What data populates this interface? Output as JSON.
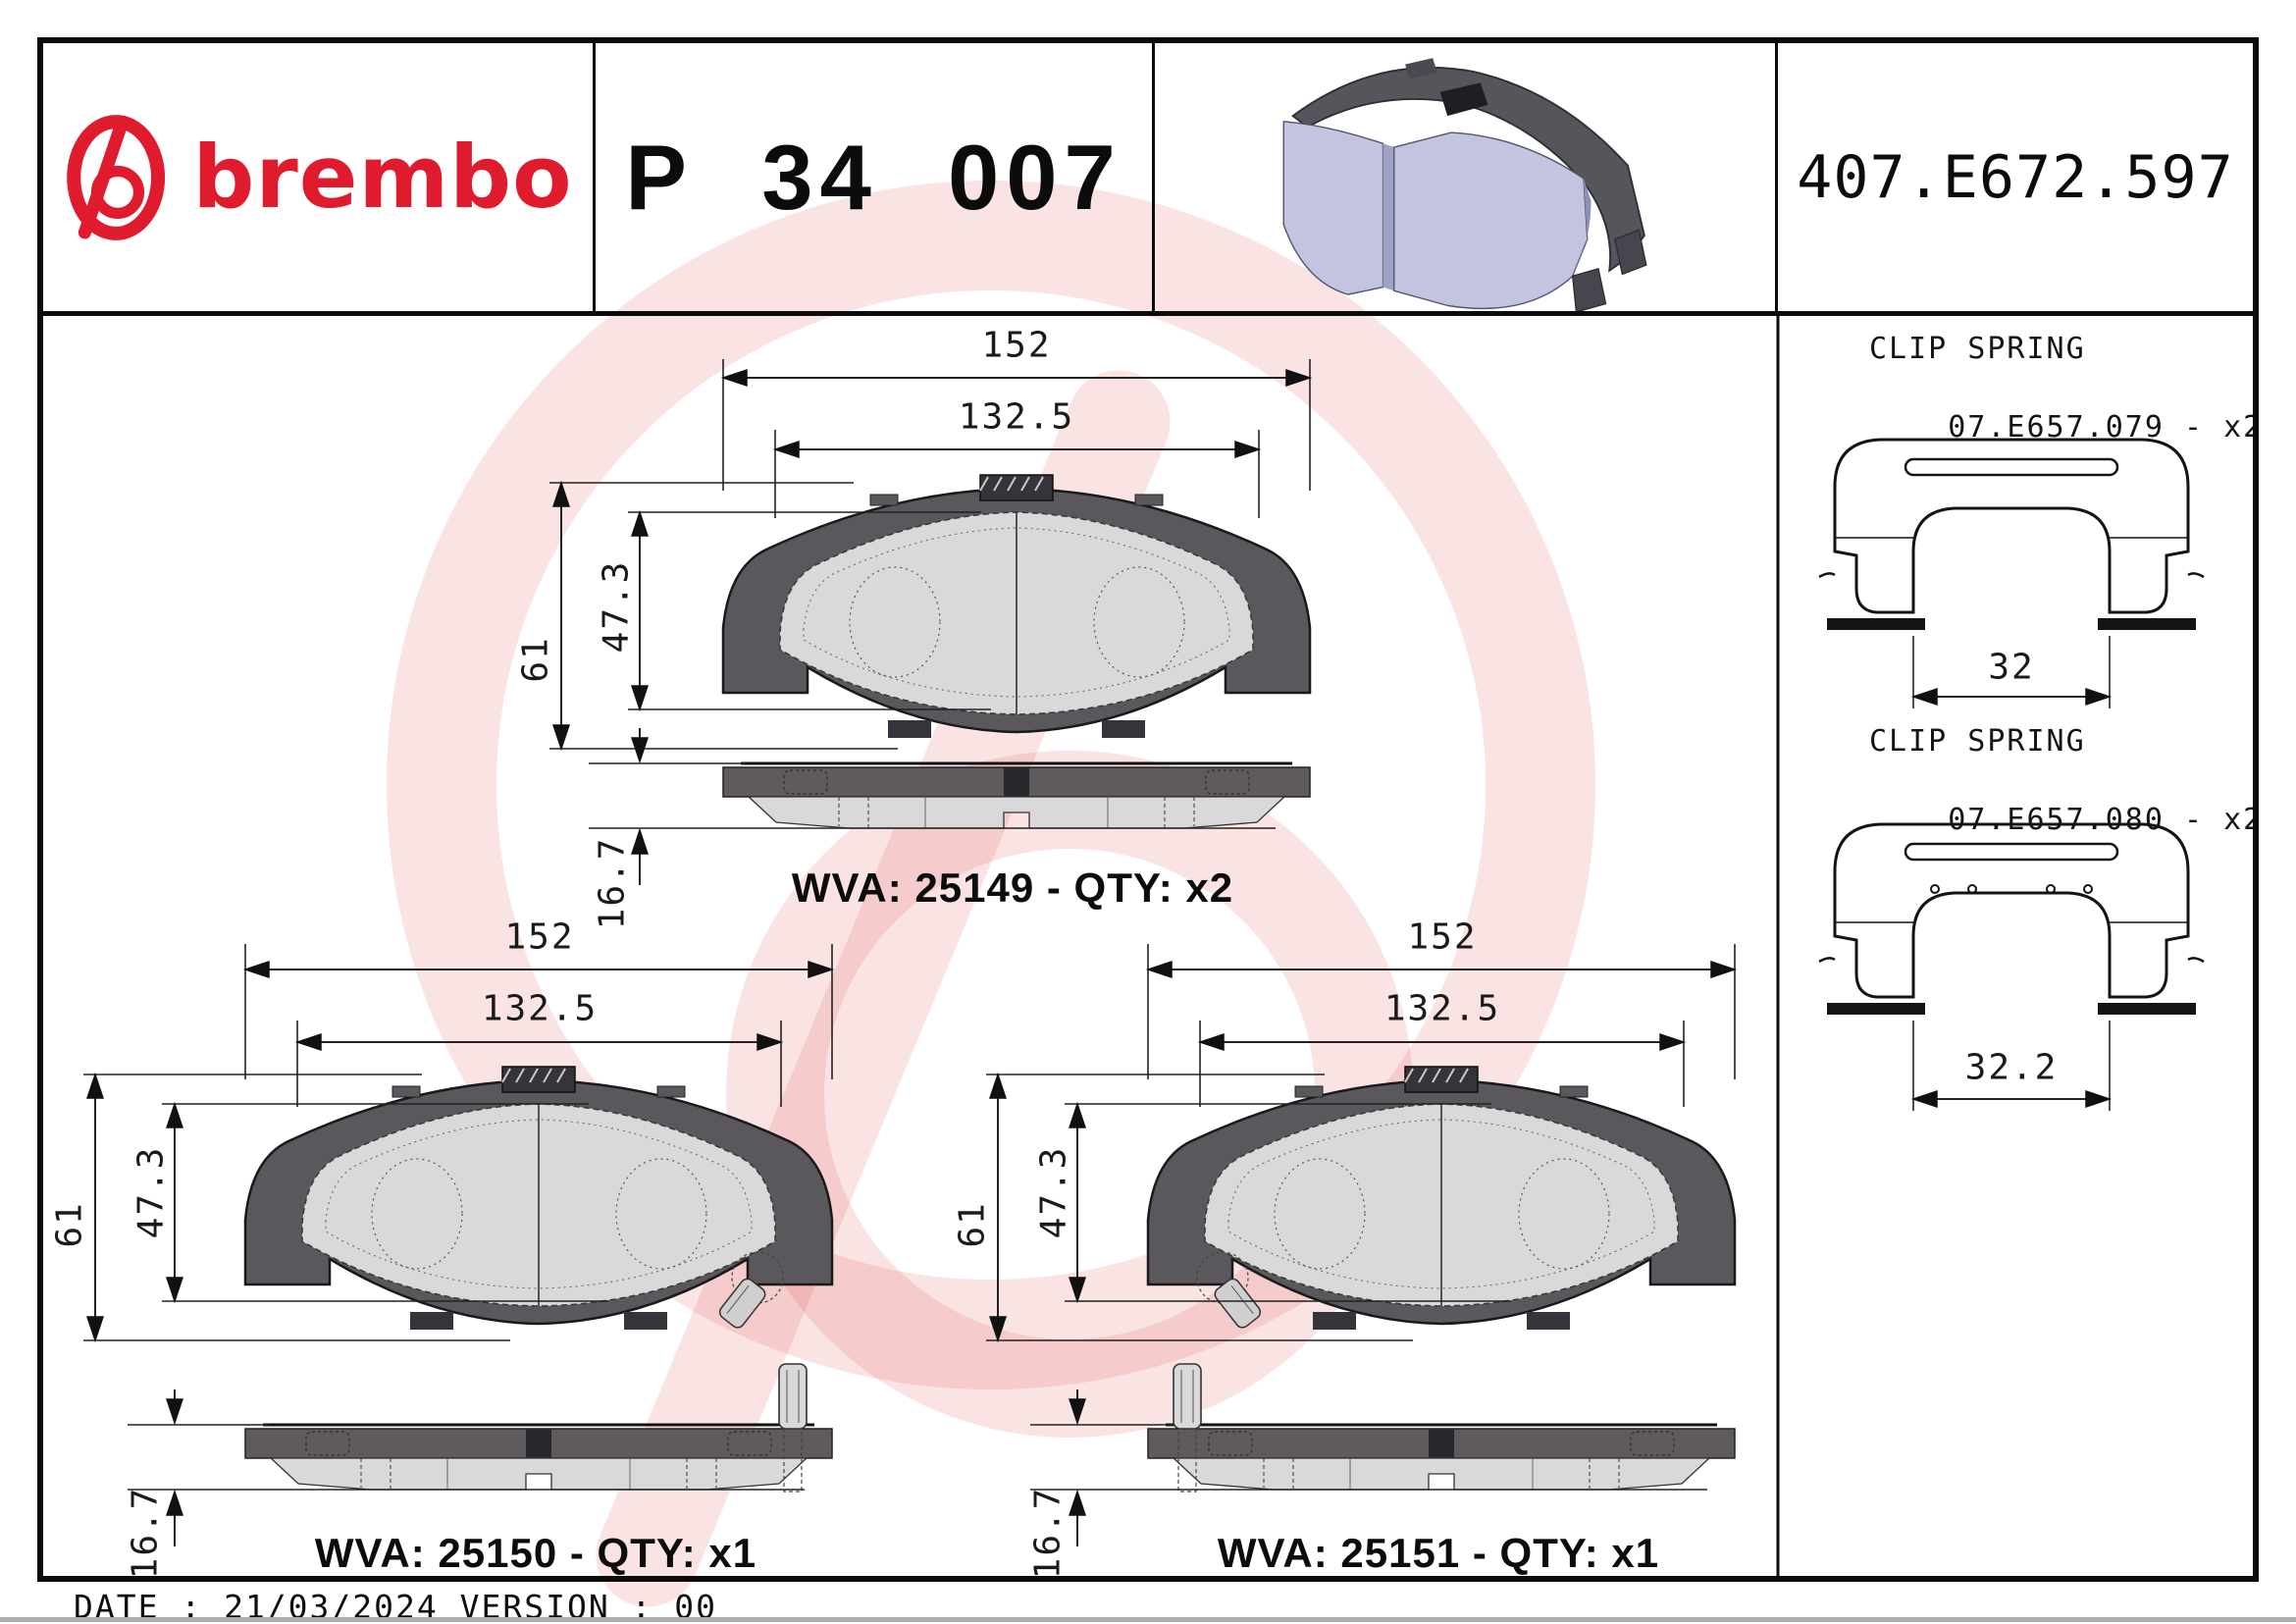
{
  "header": {
    "brand": "brembo",
    "part_number": "P 34 007",
    "reference": "407.E672.597"
  },
  "pads": [
    {
      "name": "pad-25149",
      "wva_label": "WVA: 25149 - QTY: x2",
      "dims": {
        "overall_width": "152",
        "pad_width": "132.5",
        "overall_height": "61",
        "pad_height": "47.3",
        "thickness": "16.7"
      }
    },
    {
      "name": "pad-25150",
      "wva_label": "WVA: 25150 - QTY: x1",
      "dims": {
        "overall_width": "152",
        "pad_width": "132.5",
        "overall_height": "61",
        "pad_height": "47.3",
        "thickness": "16.7"
      }
    },
    {
      "name": "pad-25151",
      "wva_label": "WVA: 25151 - QTY: x1",
      "dims": {
        "overall_width": "152",
        "pad_width": "132.5",
        "overall_height": "61",
        "pad_height": "47.3",
        "thickness": "16.7"
      }
    }
  ],
  "clip_springs": [
    {
      "title": "CLIP SPRING",
      "code": "07.E657.079 - x2",
      "width": "32"
    },
    {
      "title": "CLIP SPRING",
      "code": "07.E657.080 - x2",
      "width": "32.2"
    }
  ],
  "footer": {
    "date_version": "DATE : 21/03/2024 VERSION : 00"
  },
  "colors": {
    "brand_red": "#e01b2d",
    "backplate_gray": "#5a585c",
    "friction_gray": "#d9d9d9",
    "pad_3d_lavender": "#c3c5e0",
    "watermark_pink": "#df5252"
  }
}
